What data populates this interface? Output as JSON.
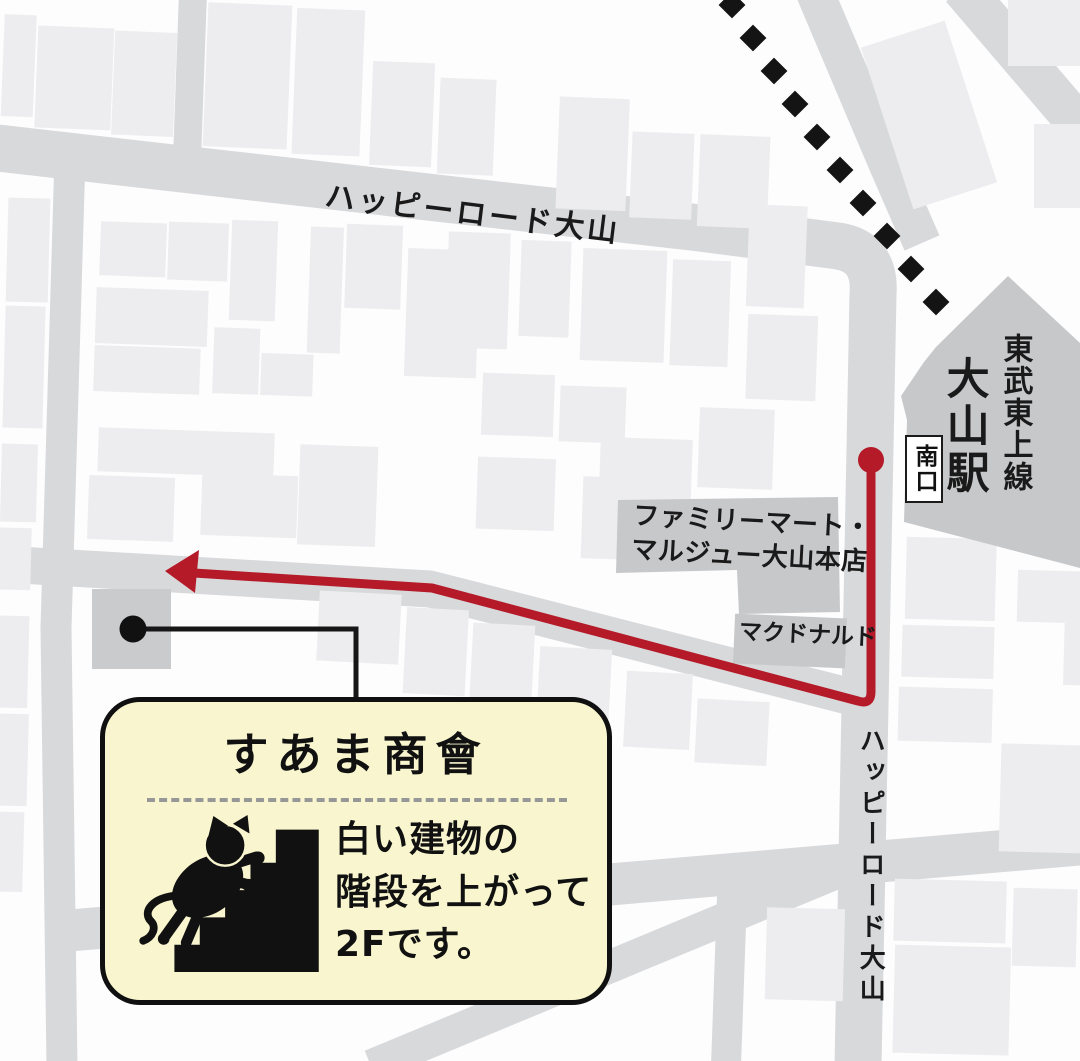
{
  "map": {
    "streets": {
      "top_road_label": "ハッピーロード大山",
      "right_road_label": "ハッピーロード大山"
    },
    "station": {
      "line_name": "東武東上線",
      "station_name": "大山駅",
      "south_exit_label": "南口"
    },
    "landmarks": {
      "familymart_line1": "ファミリーマート・",
      "familymart_line2": "マルジュー大山本店",
      "mcdonalds": "マクドナルド"
    },
    "route": {
      "color": "#b41a28",
      "start_marker": "red-dot-at-station-south-exit",
      "end_marker": "left-arrow"
    },
    "destination": {
      "marker": "black-dot",
      "callout_title": "すあま商會",
      "callout_line1": "白い建物の",
      "callout_line2": "階段を上がって",
      "callout_line3": "2Fです。",
      "callout_icon": "cat-climbing-stairs-icon",
      "callout_bg": "#f9f6cf"
    },
    "colors": {
      "street": "#d8d9db",
      "building": "#ededef",
      "landmark_building": "#c7c8ca",
      "railway": "#141414",
      "background": "#fdfdfe"
    }
  }
}
